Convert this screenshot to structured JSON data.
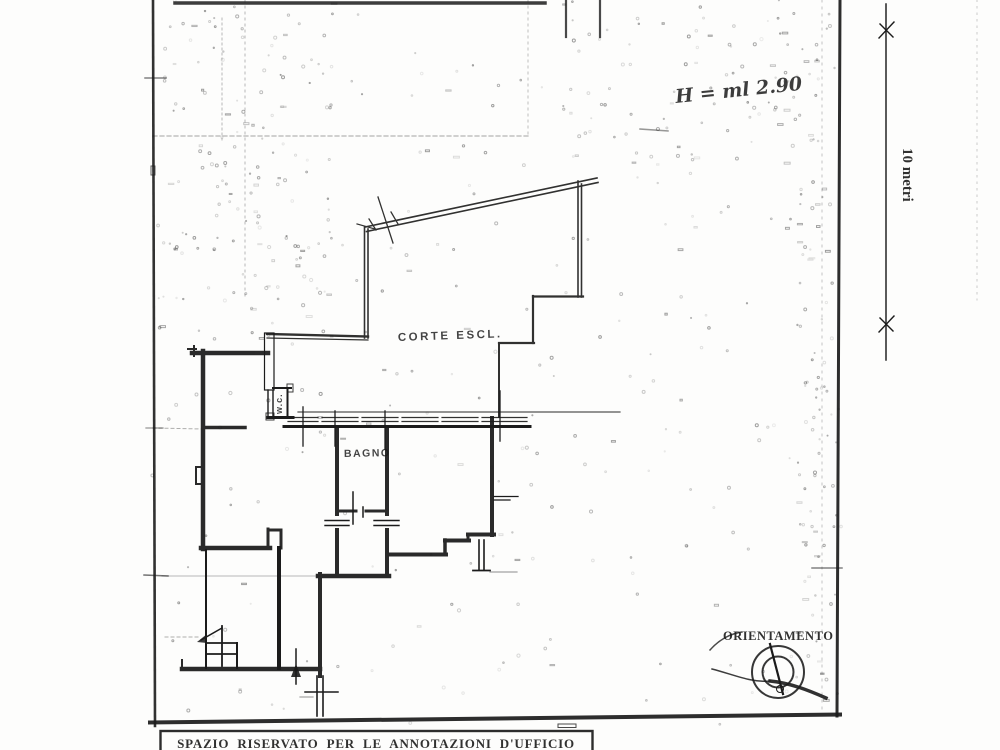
{
  "page": {
    "labels": {
      "height_note": "H = ml 2.90",
      "courtyard": "CORTE ESCL.",
      "bathroom": "BAGNO",
      "wc": "w.c.",
      "orientation": "ORIENTAMENTO",
      "scale": "10 metri",
      "footer_box": "SPAZIO RISERVATO PER LE ANNOTAZIONI D'UFFICIO"
    },
    "colors": {
      "ink": "#1b1b1b",
      "paper": "#fdfdfc"
    }
  }
}
